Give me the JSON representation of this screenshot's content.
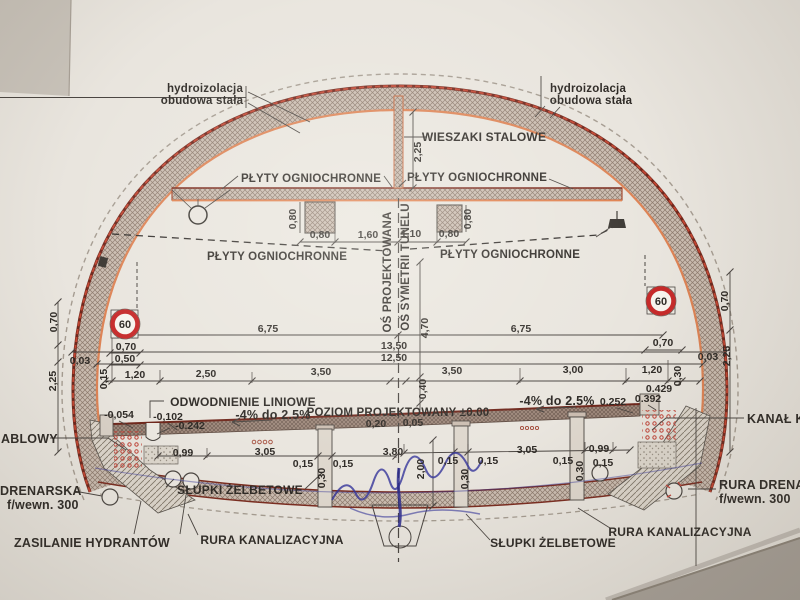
{
  "drawing": {
    "labels": {
      "hydro_left_line1": "hydroizolacja",
      "hydro_left_line2": "obudowa stała",
      "hydro_right_line1": "hydroizolacja",
      "hydro_right_line2": "obudowa stała",
      "steel_hangers": "WIESZAKI STALOWE",
      "fire_boards_top_left": "PŁYTY OGNIOCHRONNE",
      "fire_boards_top_right": "PŁYTY OGNIOCHRONNE",
      "fire_boards_mid_left": "PŁYTY OGNIOCHRONNE",
      "fire_boards_mid_right": "PŁYTY OGNIOCHRONNE",
      "axis_design": "OŚ PROJEKTOWANA",
      "axis_symmetry": "OŚ SYMETRII TUNELU",
      "linear_drainage": "ODWODNIENIE LINIOWE",
      "slope_left": "-4% do 2.5%",
      "slope_right": "-4% do 2.5%",
      "design_level": "POZIOM PROJEKTOWANY ±0.00",
      "cable_duct_left_clipped": "ABLOWY",
      "cable_duct_right_clipped": "KANAŁ K",
      "drain_pipe_left_line1": "DRENARSKA",
      "drain_pipe_left_line2": "f/wewn. 300",
      "drain_pipe_right_line1": "RURA DRENAR",
      "drain_pipe_right_line2": "f/wewn. 300",
      "hydrant_supply": "ZASILANIE HYDRANTÓW",
      "rc_posts_left": "SŁUPKI ŻELBETOWE",
      "rc_posts_right": "SŁUPKI ŻELBETOWE",
      "sewer_pipe_left": "RURA KANALIZACYJNA",
      "sewer_pipe_right": "RURA KANALIZACYJNA"
    },
    "signs": {
      "speed_limit_left": "60",
      "speed_limit_right": "60"
    },
    "dims": {
      "d01": "2,25",
      "d02": "0,80",
      "d03": "0,80",
      "d04": "1,60",
      "d05": "1,10",
      "d06": "0,80",
      "d07": "0,80",
      "d08": "6,75",
      "d09": "4,70",
      "d10": "6,75",
      "d11": "0,70",
      "d12": "0,50",
      "d13": "13,50",
      "d14": "12,50",
      "d15": "0,70",
      "d16": "0,70",
      "d17": "0,03",
      "d18": "2,25",
      "d19": "0,70",
      "d20": "2,25",
      "d21": "0,03",
      "d22": "0,15",
      "d23": "1,20",
      "d24": "2,50",
      "d25": "3,50",
      "d26": "0,40",
      "d27": "3,50",
      "d28": "3,00",
      "d29": "1,20",
      "d30": "0,30",
      "d31": "0.429",
      "d32": "0.392",
      "d33": "0.252",
      "d34": "-0,054",
      "d35": "-0,102",
      "d36": "-0.242",
      "d37": "0,20",
      "d38": "0,05",
      "d39": "0,99",
      "d40": "3,05",
      "d41": "0,15",
      "d42": "0,30",
      "d43": "0,15",
      "d44": "3,80",
      "d45": "2,00",
      "d46": "0,15",
      "d47": "0,30",
      "d48": "0,15",
      "d49": "3,05",
      "d50": "0,15",
      "d51": "0,30",
      "d52": "0,99",
      "d53": "0,15"
    },
    "colors": {
      "paper": "#e9e5de",
      "table": "#a9a29a",
      "line_dark": "#3a3631",
      "lining_outer_edge": "#7a2c20",
      "lining_inner_edge": "#dd8355",
      "accent_orange": "#e0814f",
      "sign_red": "#c62a2a",
      "handwriting_blue": "#34349a",
      "cable_marker_red": "#c0453a"
    }
  }
}
